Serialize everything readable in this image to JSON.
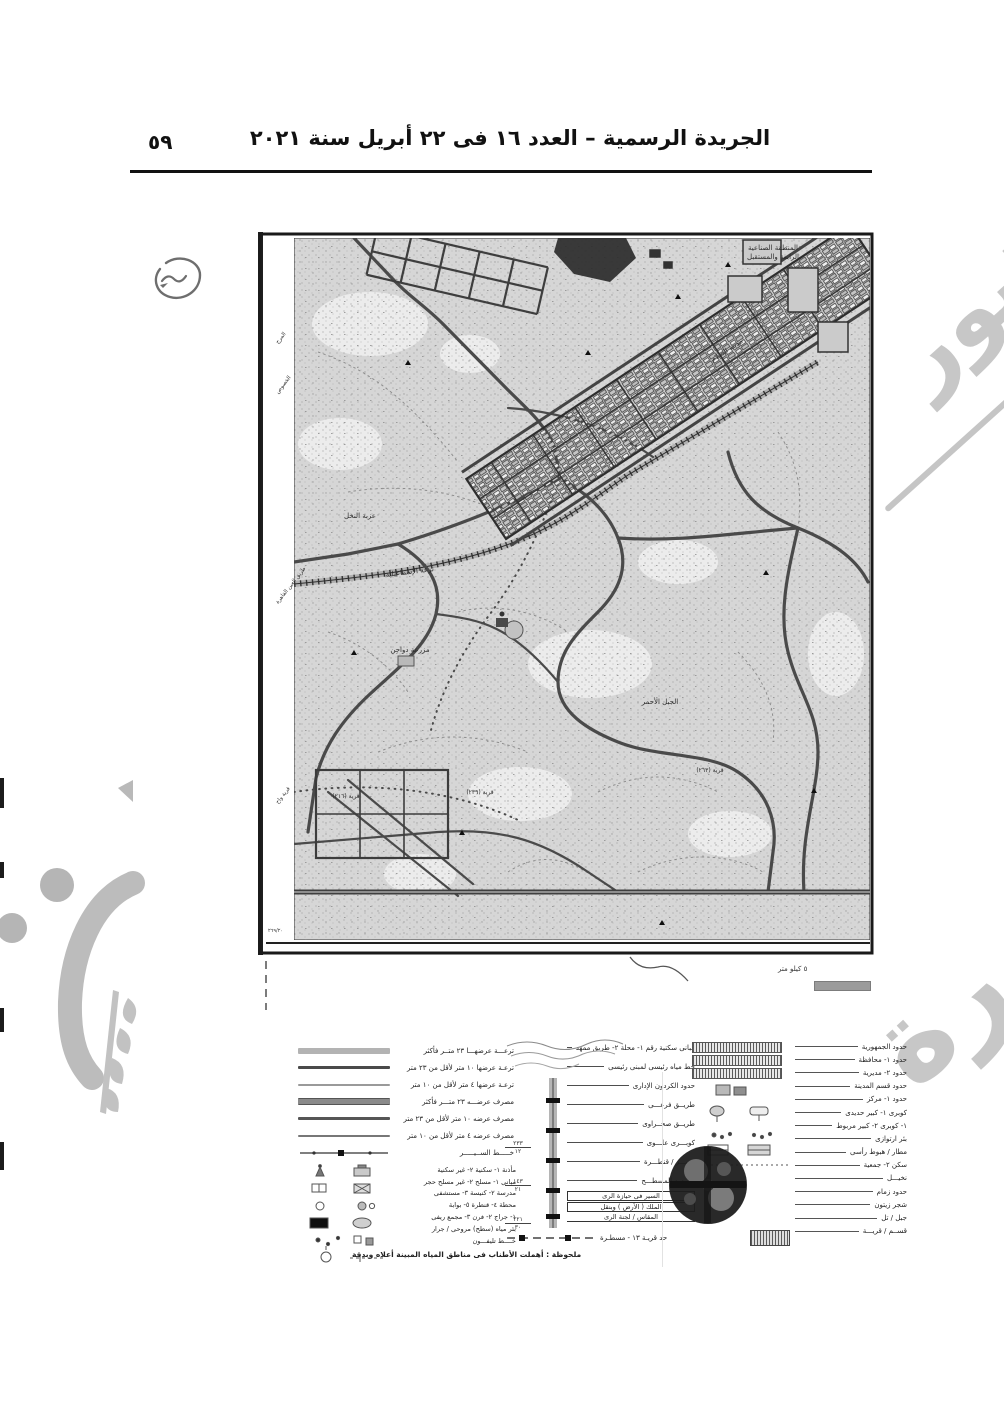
{
  "header": {
    "title": "الجريدة الرسمية – العدد ١٦ فى ٢٢ أبريل سنة ٢٠٢١",
    "page_number": "٥٩"
  },
  "watermark": {
    "upper": "المنشور",
    "lower": "صورة"
  },
  "map": {
    "margin_labels": [
      "المرج",
      "الخصوص",
      "طريق العين القاهرة",
      "قرية واح"
    ],
    "labels": {
      "industrial_zone_1": "المنطقة الصناعية",
      "industrial_zone_2": "الرابعة والمستقبل",
      "salam_city": "مدينة السلام",
      "ezbet_elnakhl": "عزبة النخل",
      "gebel_ahmar": "الجبل الأحمر",
      "ismailia_canal": "ترعة الإسماعيلية",
      "poultry_farm": "مزرعة دواجن",
      "village_216": "قرية (٢١٦)",
      "village_239": "قرية (٢٣٩)",
      "village_263": "قرية (٢٦٣)"
    },
    "corner_number": "٢٦٩/٢٠",
    "scale_label": "٥ كيلو متر"
  },
  "legend": {
    "lines": [
      {
        "label": "ترعـــة عرضهـــا ٢٣ متــر فأكثر"
      },
      {
        "label": "ترعـة عرضها ١٠ متر لأقل من ٢٣ متر"
      },
      {
        "label": "ترعـة عرضها ٤ متر لأقل من ١٠ متر"
      },
      {
        "label": "مصرف عرضـــه ٢٣ متـــر فأكثر"
      },
      {
        "label": "مصرف عرضه ١٠ متر لأقل من ٢٣ متر"
      },
      {
        "label": "مصرف عرضه ٤ متر لأقل من ١٠ متر"
      }
    ],
    "line7_label": "خـــــط الســيـــــر",
    "symbols": [
      {
        "label": "مأذنة ١- سكنية ٢- غير سكنية"
      },
      {
        "label": "مبانى ١- مسلح ٢- غير مسلح حجر"
      },
      {
        "label": "مدرسة ٢- كنيسة ٣- مستشفى"
      },
      {
        "label": "محطة ٤- قنطرة ٥- بوابة"
      },
      {
        "label": "١- جراج ٢- فرن ٣- مجمع ريفى"
      },
      {
        "label": "بئر مياه (سطح) مروحى / جرار"
      },
      {
        "label": "خــــط تليفـــون"
      }
    ],
    "middle": {
      "fractions": [
        {
          "top": "٢٣٣",
          "bottom": "١٢"
        },
        {
          "top": "١٤٣",
          "bottom": "٢١"
        },
        {
          "top": "٢٢١",
          "bottom": "٣٠"
        }
      ],
      "rows": [
        {
          "label": "مبانى سكنية رقم ١- محلة ٢- طريق ممهد"
        },
        {
          "label": "خط مياه رئيسى لمبنى رئيسى"
        },
        {
          "label": "حدود الكردون الإدارى"
        },
        {
          "label": "طريــق فرعـــى"
        },
        {
          "label": "طريــق صحــراوى"
        },
        {
          "label": "كوبـــرى علـــوى"
        },
        {
          "label": "معبـــر / قنطـــرة"
        },
        {
          "label": "حـــدود المسطـــح"
        }
      ],
      "boxed": [
        "السير فى حيازة الرى",
        "الملك ( الأرض ) وبنقل"
      ],
      "boxed2": "المقاس / لجنة الرى",
      "bottom_row": "حد قريـة ١٣ - مسطـرة"
    },
    "right": [
      {
        "label": "حدود الجمهورية"
      },
      {
        "label": "حدود ١- محافظة"
      },
      {
        "label": "حدود ٢- مديرية"
      },
      {
        "label": "حدود قسم المدينة"
      },
      {
        "label": "حدود ١- مركز"
      },
      {
        "label": "كوبرى ١- كبير حديدى"
      },
      {
        "label": "١- كوبرى ٢- كبير مربوط"
      },
      {
        "label": "بئر ارتوازى"
      },
      {
        "label": "مطار / هبوط رأسى"
      },
      {
        "label": "سكن ٢- جمعية"
      },
      {
        "label": "نخيـــل"
      },
      {
        "label": "حدود زمام"
      },
      {
        "label": "شجر زيتون"
      },
      {
        "label": "جبل / تل"
      },
      {
        "label": "قســم / قريـــة"
      }
    ],
    "note": "ملحوظة : أهملت الأطناب فى مناطق المياه المبينة أعلاه وبدقة"
  }
}
